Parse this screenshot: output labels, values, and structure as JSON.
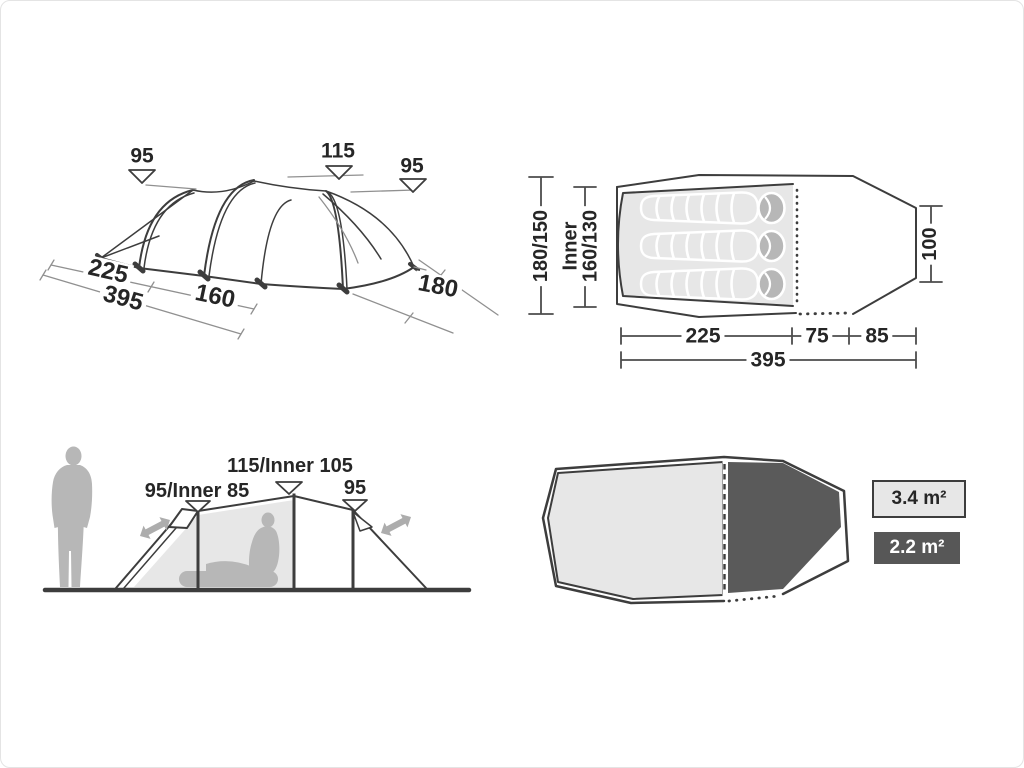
{
  "colors": {
    "page_border": "#e4e4e4",
    "line_dark": "#3d3d3d",
    "line_dim": "#909090",
    "dim_dark": "#4c4c4c",
    "text": "#262626",
    "fill_light": "#e7e7e7",
    "fill_mid": "#b7b7b7",
    "fill_dark": "#5a5a5a",
    "arrow": "#adadad",
    "legend_dark_bg": "#575757",
    "legend_light_bg": "#e7e7e7"
  },
  "perspective_view": {
    "height_left": "95",
    "height_middle": "115",
    "height_right": "95",
    "dim_front_section": "225",
    "dim_total_length": "395",
    "dim_mid_section": "160",
    "dim_depth": "180"
  },
  "floor_plan": {
    "dim_outer_width": "180/150",
    "dim_inner_width_label": "Inner",
    "dim_inner_width": "160/130",
    "dim_rear_width": "100",
    "dim_inner_length": "225",
    "dim_vestibule": "75",
    "dim_porch": "85",
    "dim_total_length": "395"
  },
  "side_view": {
    "height_left": "95/Inner 85",
    "height_middle": "115/Inner 105",
    "height_right": "95"
  },
  "area_legend": {
    "inner_area": "3.4 m²",
    "vestibule_area": "2.2 m²"
  }
}
